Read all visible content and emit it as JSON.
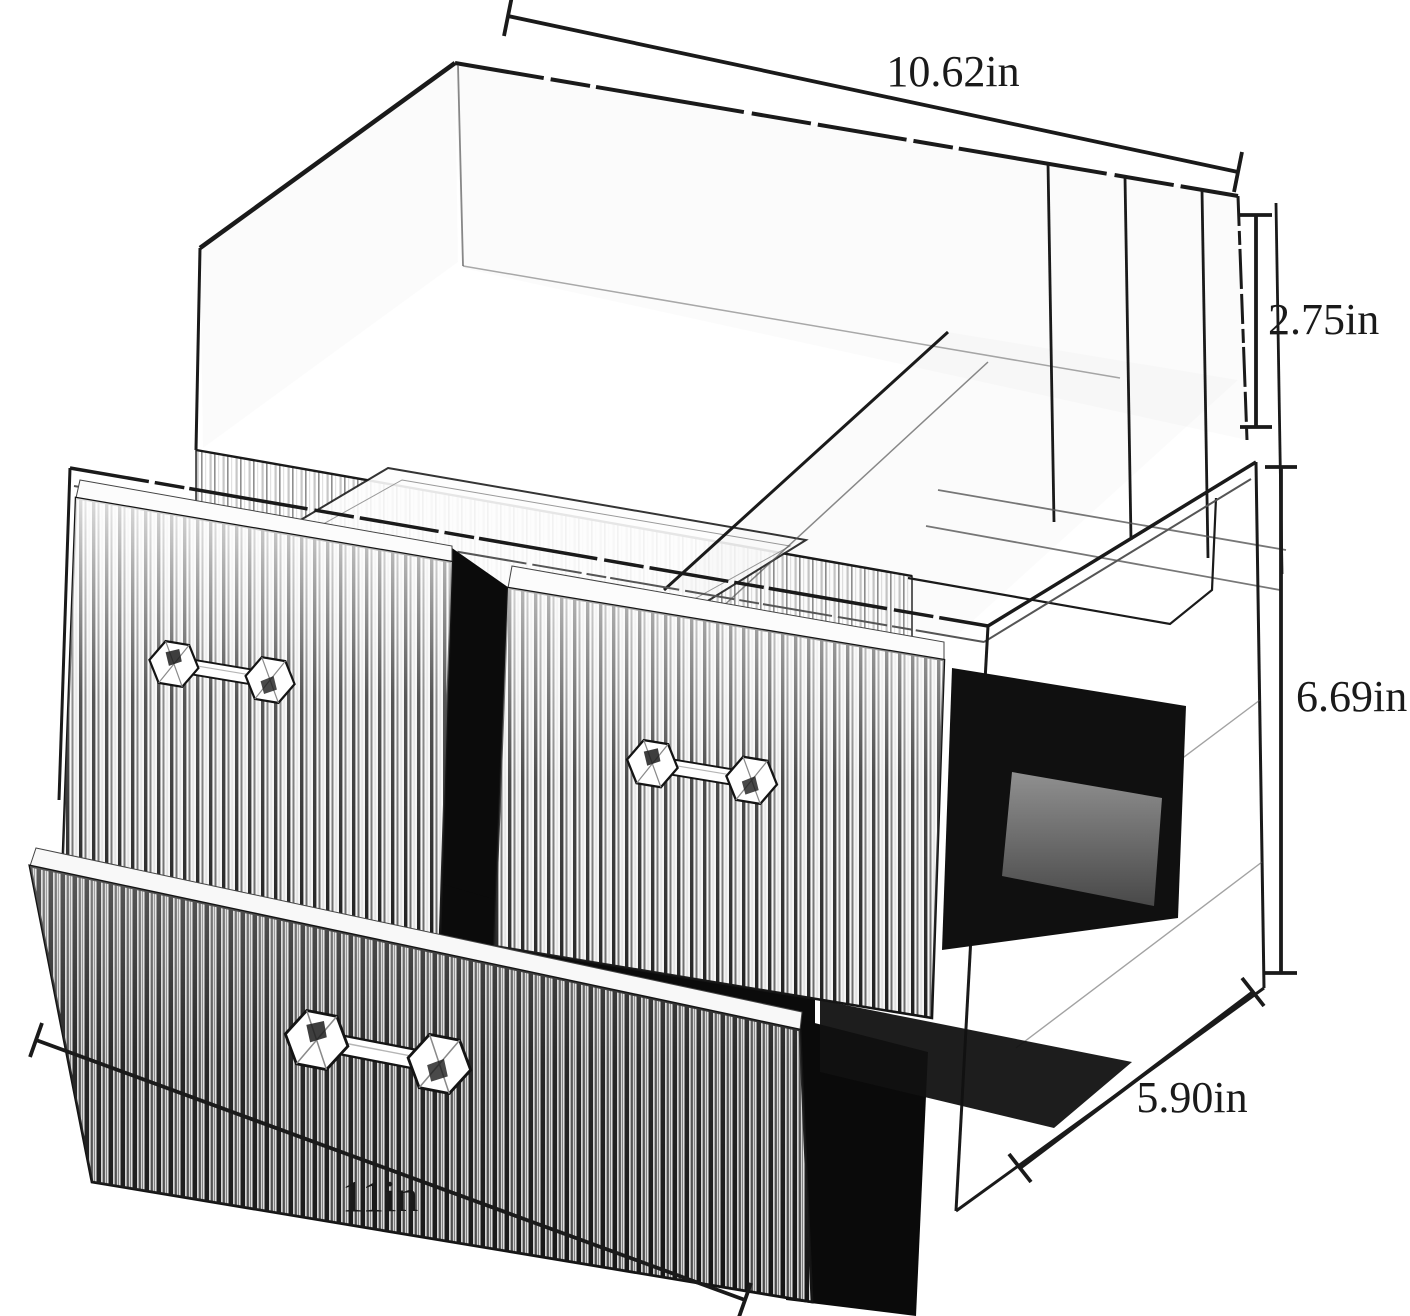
{
  "diagram": {
    "description": "Dimension diagram of a clear acrylic cosmetic organizer: open top tray with divider compartments over a cabinet with three ribbed drawers and crystal knobs",
    "dimensions": {
      "top_width": "10.62in",
      "top_height": "2.75in",
      "body_height": "6.69in",
      "depth": "5.90in",
      "bottom_width": "11in"
    },
    "colors": {
      "line": "#1a1a1a",
      "interior_dark": "#0b0b0b",
      "interior_gray": "#8c8c8c",
      "background": "#ffffff"
    }
  }
}
